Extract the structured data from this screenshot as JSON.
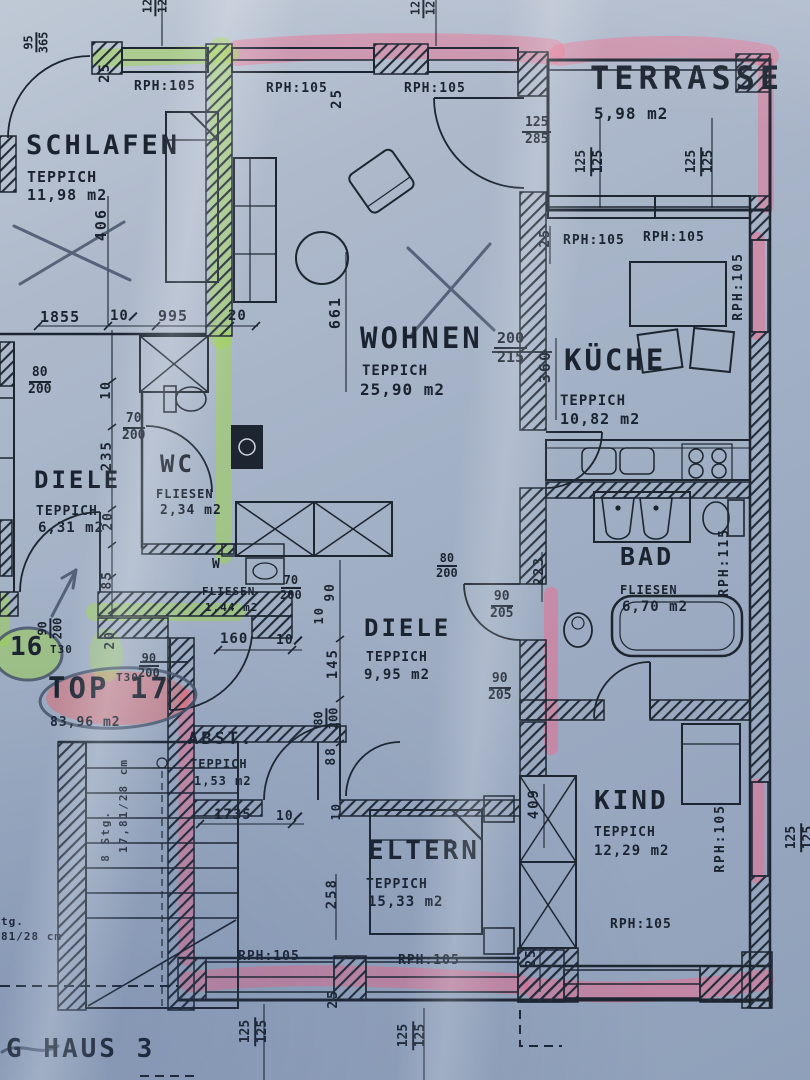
{
  "apartment": {
    "unit_label": "TOP 17",
    "unit_area": "83,96 m2",
    "neighbor_unit": "16",
    "door_type": "T30",
    "house_label": "G HAUS 3"
  },
  "rooms": {
    "schlafen": {
      "name": "SCHLAFEN",
      "floor": "TEPPICH",
      "area": "11,98 m2"
    },
    "terrasse": {
      "name": "TERRASSE",
      "area": "5,98 m2"
    },
    "wohnen": {
      "name": "WOHNEN",
      "floor": "TEPPICH",
      "area": "25,90 m2"
    },
    "kueche": {
      "name": "KÜCHE",
      "floor": "TEPPICH",
      "area": "10,82 m2"
    },
    "diele_16": {
      "name": "DIELE",
      "floor": "TEPPICH",
      "area": "6,31 m2"
    },
    "wc_16": {
      "name": "WC",
      "floor": "FLIESEN",
      "area": "2,34 m2"
    },
    "wc_klein": {
      "name": "W",
      "floor": "FLIESEN",
      "area": "1,44 m2"
    },
    "diele_17": {
      "name": "DIELE",
      "floor": "TEPPICH",
      "area": "9,95 m2"
    },
    "bad": {
      "name": "BAD",
      "floor": "FLIESEN",
      "area": "6,70 m2"
    },
    "abstellraum": {
      "name": "ABST.",
      "floor": "TEPPICH",
      "area": "1,53 m2"
    },
    "eltern": {
      "name": "ELTERN",
      "floor": "TEPPICH",
      "area": "15,33 m2"
    },
    "kind": {
      "name": "KIND",
      "floor": "TEPPICH",
      "area": "12,29 m2"
    }
  },
  "parapet": {
    "rph105": "RPH:105",
    "rph115": "RPH:115"
  },
  "stairs": {
    "steps": "8 Stg.",
    "riser": "17,81/28 cm",
    "fragment_a": "tg.",
    "fragment_b": "81/28 cm"
  },
  "colors": {
    "ink": "#1b2330",
    "pink_marker": "#f06a8c",
    "green_marker": "#9ed649",
    "red_marker": "#f56161"
  },
  "dims": {
    "d10": "10",
    "d20": "20",
    "d25": "25",
    "d70": "70",
    "d80": "80",
    "d85": "85",
    "d88": "88",
    "d90": "90",
    "d95": "95",
    "d125": "125",
    "d145": "145",
    "d160": "160",
    "d200": "200",
    "d205": "205",
    "d215": "215",
    "d223": "223",
    "d235": "235",
    "d258": "258",
    "d285": "285",
    "d360": "360",
    "d365": "365",
    "d406": "406",
    "d409": "409",
    "d661": "661",
    "d995": "995",
    "d1735": "1735",
    "d1855": "1855"
  }
}
